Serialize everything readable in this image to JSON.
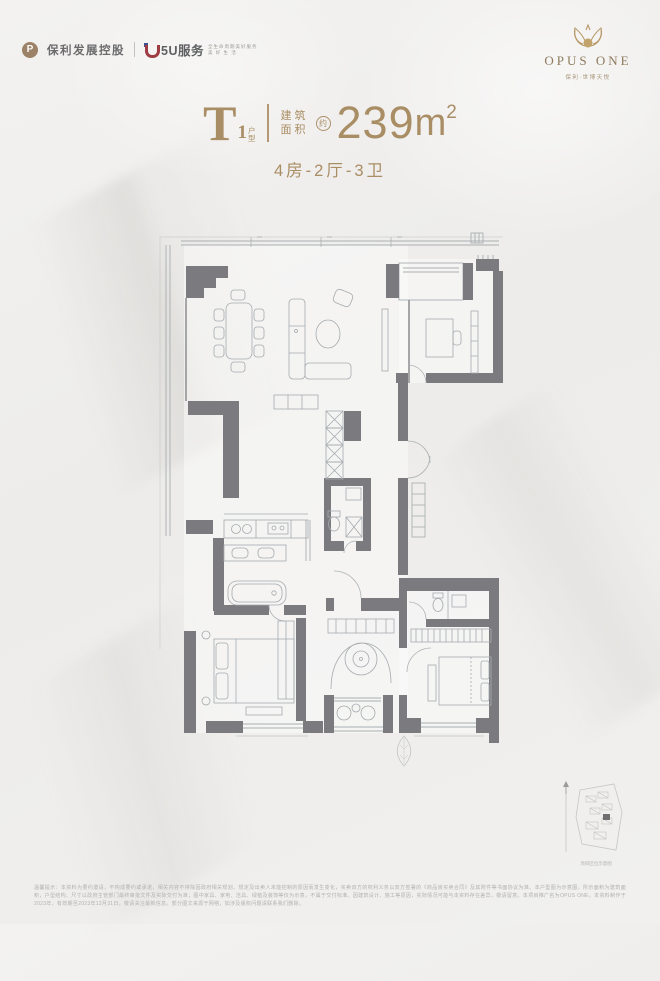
{
  "header": {
    "poly": {
      "logo_letter": "P",
      "name": "保利发展控股"
    },
    "five_u": {
      "name": "5U服务",
      "tagline_line1": "全生命周期美好服务",
      "tagline_line2": "美 好 生 活"
    },
    "opus": {
      "name": "OPUS ONE",
      "subtitle": "保利·世博天悦"
    }
  },
  "title": {
    "letter": "T",
    "index": "1",
    "suffix": "户型",
    "area_label_1": "建筑",
    "area_label_2": "面积",
    "approx": "约",
    "area_number": "239",
    "area_unit": "m",
    "area_sup": "2",
    "layout": "4房-2厅-3卫"
  },
  "site_sketch": {
    "caption": "项目区位示意图"
  },
  "disclaimer": "温馨提示：本资料为要约邀请，不构成要约或承诺，相关内容不排除因政府相关规划、规定及出卖人未能控制的原因而发生变化，买卖双方的权利义务以双方签署的《商品房买卖合同》及其附件等书面协议为准。本户型图为示意图，所示面积为建筑面积，户型结构、尺寸以政府主管部门最终审批文件及实际交付为准；图中家具、家电、洁具、绿植及装饰等仅为示意，不属于交付标准。因建筑设计、施工等原因，实际情况可能与本资料存在差异，敬请留意。本项目推广名为OPUS ONE。本资料制作于2023年，有效期至2023年12月31日，敬请关注最新信息。部分图文来源于网络，如涉及版权问题请联系我们删除。",
  "colors": {
    "accent": "#a98d64",
    "wall": "#7b7b7f",
    "line": "#a5aaae"
  }
}
